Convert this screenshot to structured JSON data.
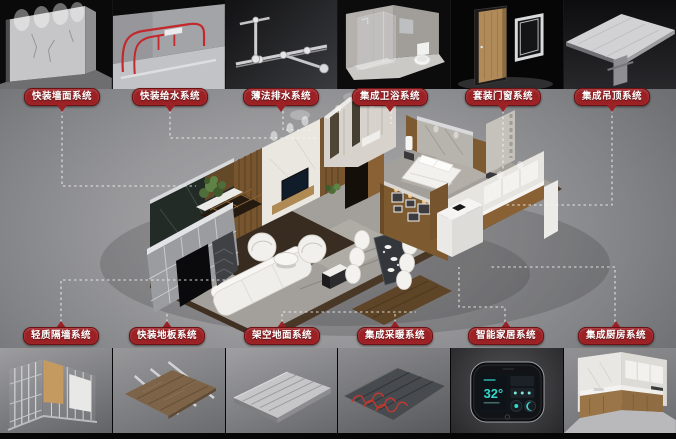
{
  "systems": {
    "top": [
      {
        "label": "快装墙面系统",
        "icon": "wall-surface-render"
      },
      {
        "label": "快装给水系统",
        "icon": "water-supply-render"
      },
      {
        "label": "薄法排水系统",
        "icon": "drainage-render"
      },
      {
        "label": "集成卫浴系统",
        "icon": "bathroom-render"
      },
      {
        "label": "套装门窗系统",
        "icon": "door-window-render"
      },
      {
        "label": "集成吊顶系统",
        "icon": "ceiling-render"
      }
    ],
    "bottom": [
      {
        "label": "轻质隔墙系统",
        "icon": "partition-wall-render"
      },
      {
        "label": "快装地板系统",
        "icon": "floor-panel-render"
      },
      {
        "label": "架空地面系统",
        "icon": "raised-floor-render"
      },
      {
        "label": "集成采暖系统",
        "icon": "heating-render"
      },
      {
        "label": "智能家居系统",
        "icon": "smart-home-render"
      },
      {
        "label": "集成厨房系统",
        "icon": "kitchen-render"
      }
    ]
  },
  "smart_panel": {
    "temperature": "32°"
  },
  "colors": {
    "badge": "#9b2125",
    "badge_border": "#6c1114",
    "badge_text": "#ffffff",
    "leader_line": "#f4f4f4",
    "accent_pipe_red": "#c2282c",
    "screen_teal": "#35d8cb"
  }
}
